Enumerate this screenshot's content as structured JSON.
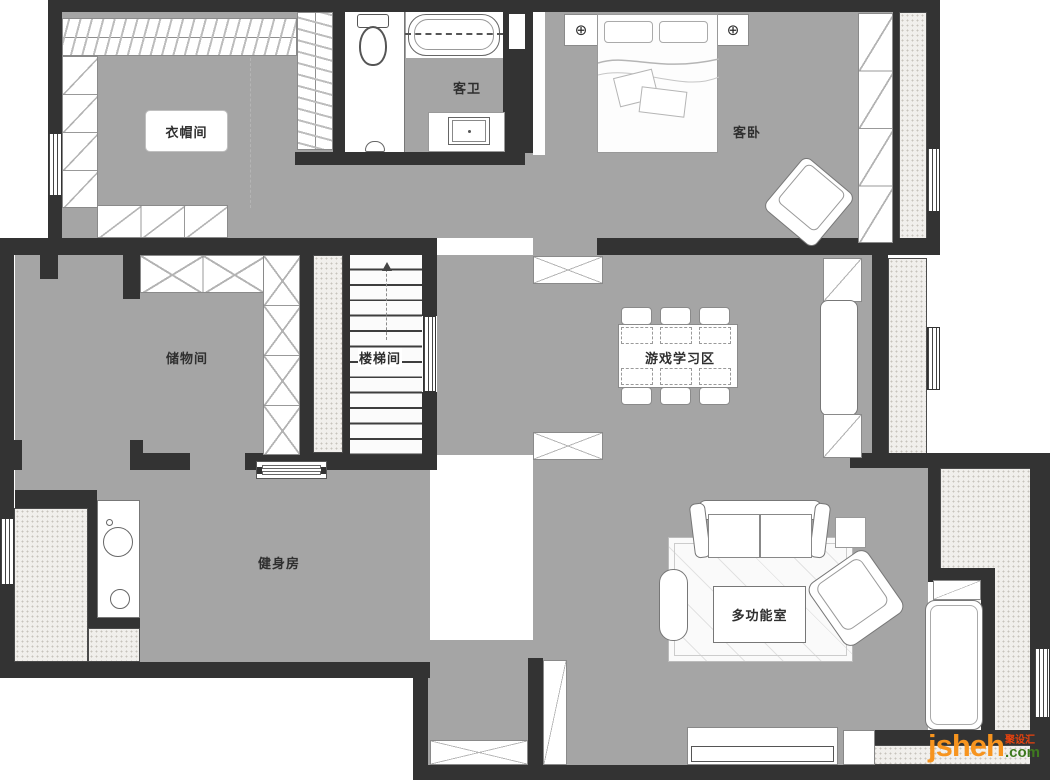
{
  "title": "二层户型平面布置图",
  "colors": {
    "wall": "#333333",
    "floor": "#a5a5a5",
    "hatch": "#f1efec",
    "furniture_outline": "#8a8a8a",
    "watermark_orange": "#f7941e",
    "watermark_green": "#3f7a1f",
    "watermark_red": "#e8420e"
  },
  "rooms": {
    "cloakroom": {
      "label": "衣帽间"
    },
    "guest_bath": {
      "label": "客卫"
    },
    "guest_bedroom": {
      "label": "客卧"
    },
    "storage": {
      "label": "储物间"
    },
    "staircase": {
      "label": "楼梯间"
    },
    "game_study": {
      "label": "游戏学习区"
    },
    "gym": {
      "label": "健身房"
    },
    "multi_function": {
      "label": "多功能室"
    }
  },
  "symbols": {
    "lamp": "⊕"
  },
  "watermark": {
    "brand": "jsheh",
    "suffix": ".com",
    "cn": "聚设汇"
  }
}
